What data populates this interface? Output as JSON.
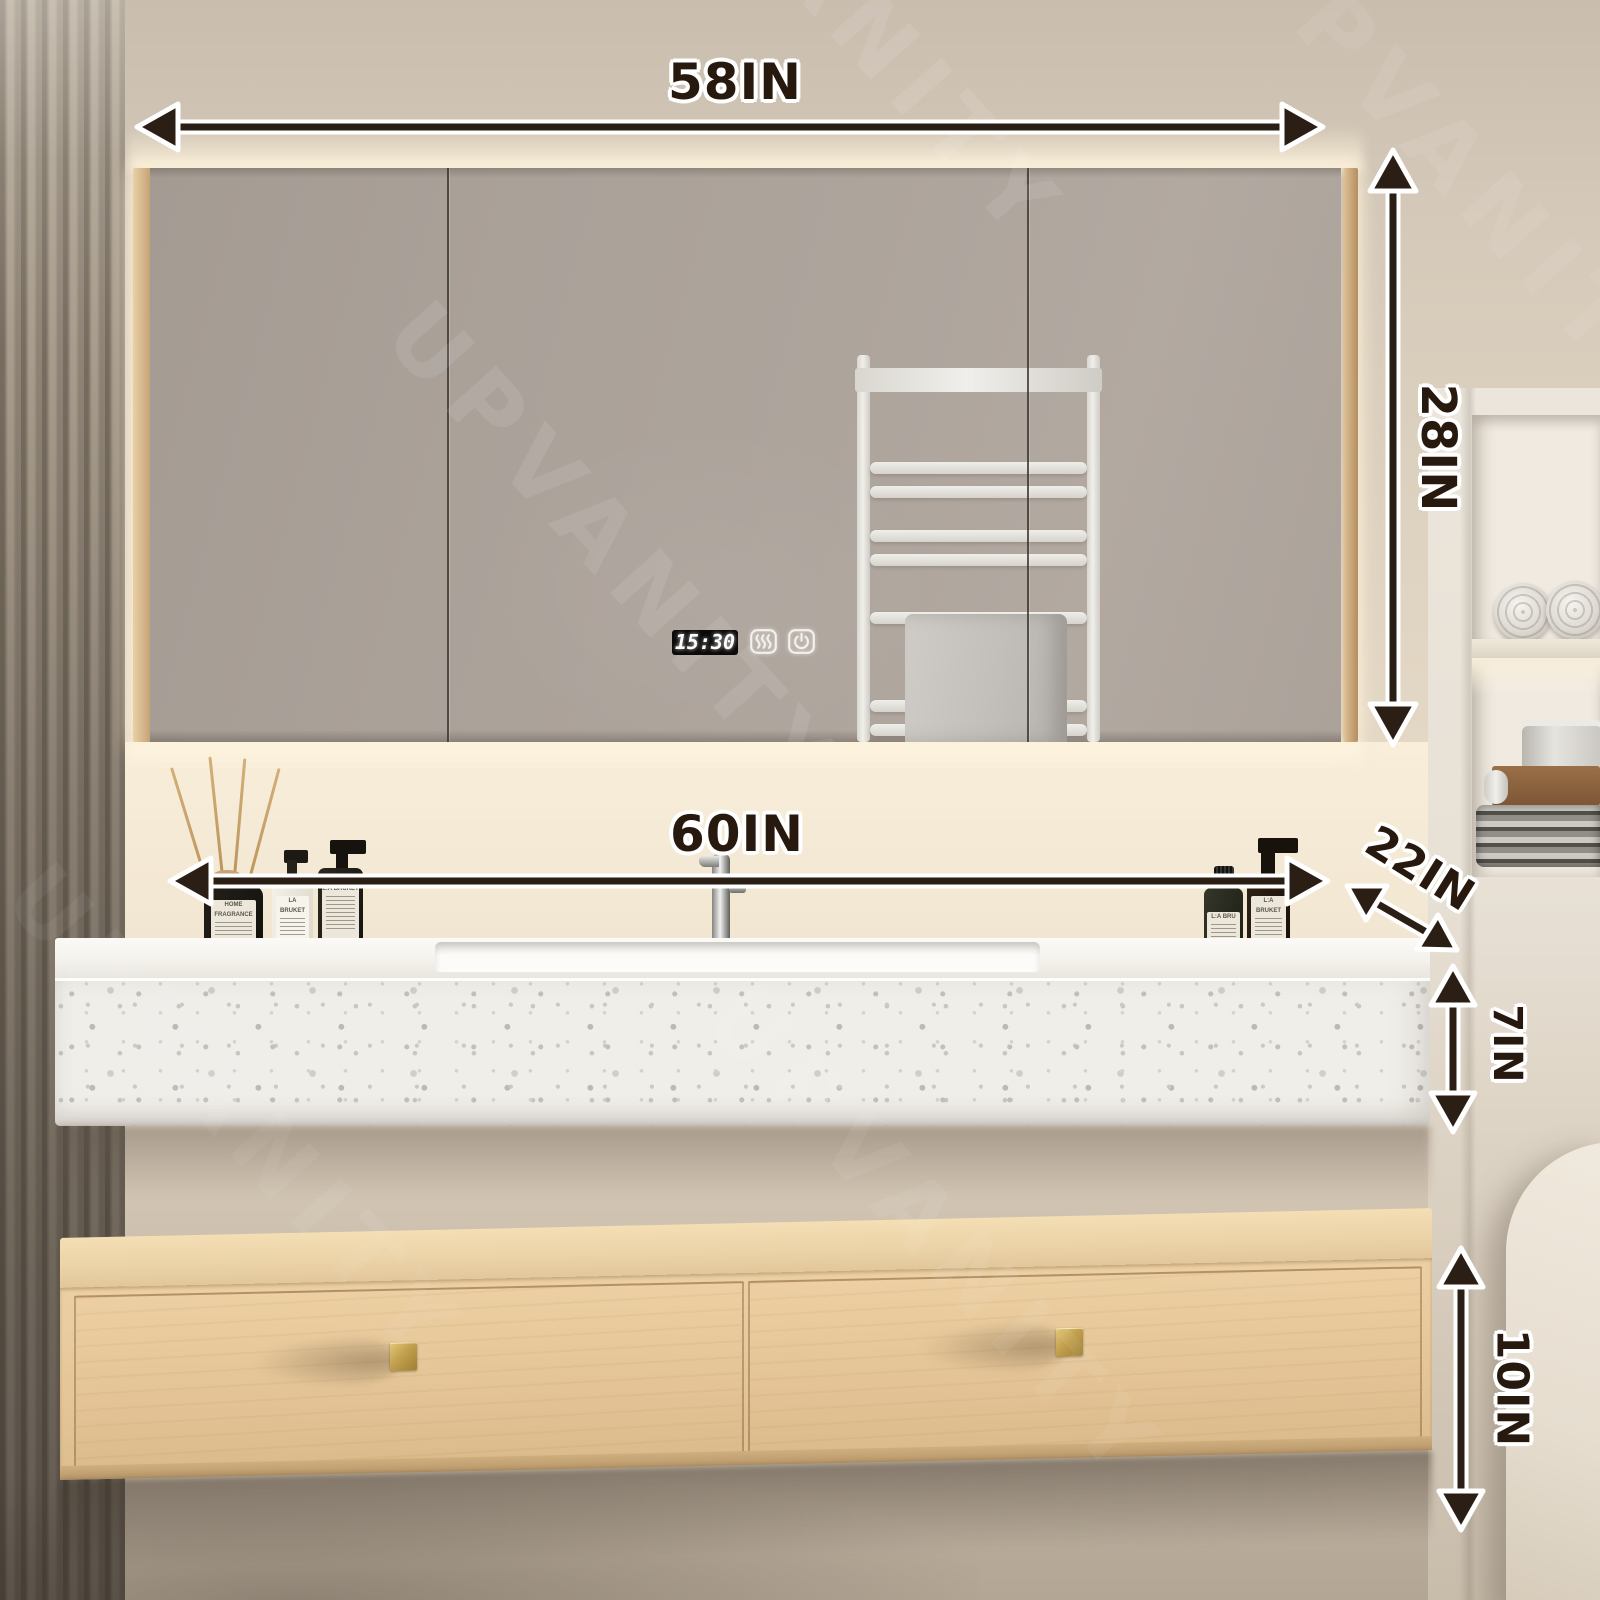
{
  "watermark": {
    "text": "UPVANITY"
  },
  "dimensions": {
    "cabinet_width": "58IN",
    "cabinet_height": "28IN",
    "vanity_width": "60IN",
    "vanity_depth": "22IN",
    "countertop_height": "7IN",
    "drawer_unit_height": "10IN"
  },
  "mirror_display": {
    "time": "15:30"
  },
  "decor_bottles": {
    "diffuser_label": "HOME FRAGRANCE",
    "soap_label_small": "LA BRUKET",
    "soap_label_dark": "L:A BRUKET",
    "dropper_label": "L:A BRU",
    "pump_label_right": "L:A BRUKET"
  },
  "palette": {
    "arrow": "#2b1f15",
    "label_text": "#27190e",
    "label_outline": "#ffffff",
    "wood": "#e7c99c",
    "gold": "#c2a04e",
    "mirror": "#a89f97",
    "terrazzo": "#f0eee9",
    "backlight": "#f8eed8",
    "wall": "#d8ccbc"
  }
}
